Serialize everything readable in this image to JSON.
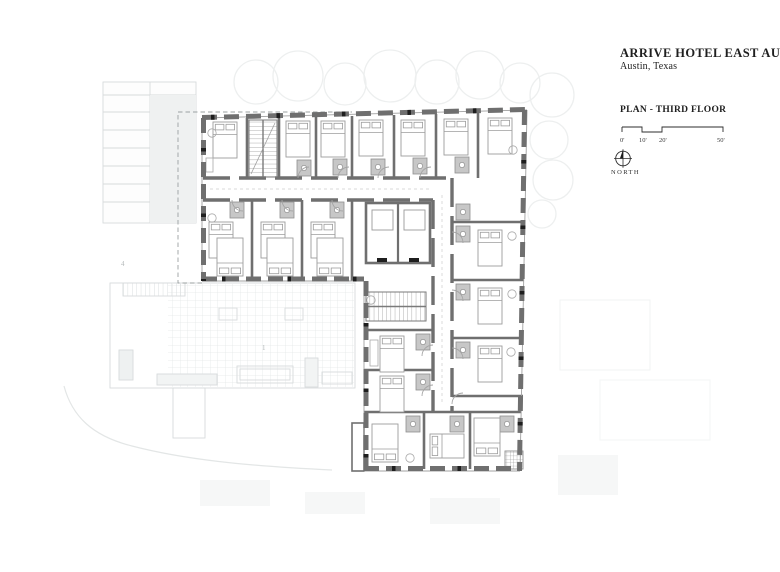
{
  "title_block": {
    "title": "ARRIVE HOTEL EAST AUSTIN",
    "subtitle": "Austin, Texas",
    "plan_label": "PLAN - THIRD FLOOR",
    "scale_ticks": [
      "0'",
      "10'",
      "20'",
      "50'"
    ],
    "north_label": "NORTH"
  },
  "plan": {
    "label_neighbor_roof": "4",
    "label_pool_deck": "1"
  },
  "colors": {
    "wall": "#6f6f6f",
    "wall_accent": "#1e1e1e",
    "bathroom_fill": "#c7c7c7",
    "context_line": "#d7dbdc",
    "paper": "#ffffff",
    "text": "#1f1f1f"
  }
}
